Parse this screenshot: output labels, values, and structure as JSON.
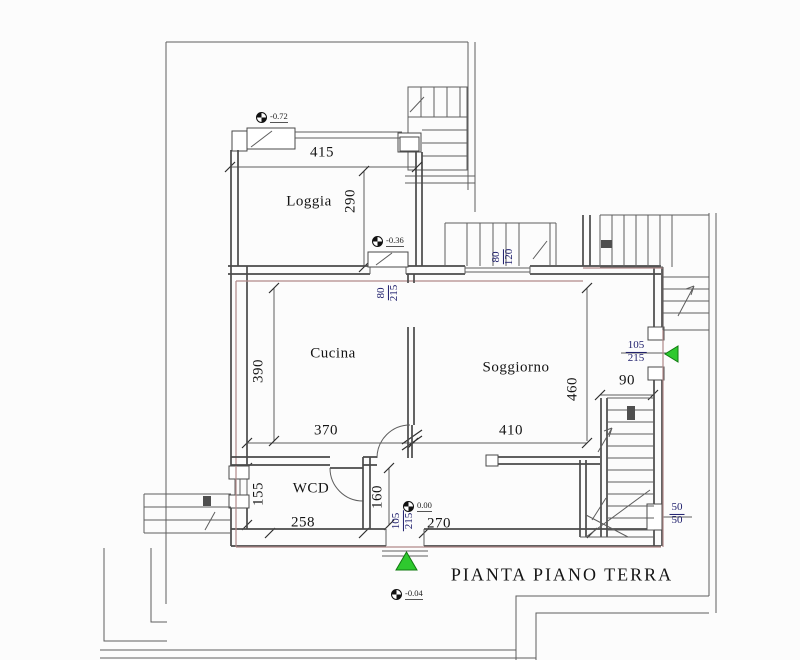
{
  "title": "PIANTA PIANO TERRA",
  "rooms": {
    "loggia": "Loggia",
    "cucina": "Cucina",
    "soggiorno": "Soggiorno",
    "wcd": "WCD"
  },
  "levels": {
    "upper_terrace": "-0.72",
    "loggia": "-0.36",
    "interior": "0.00",
    "exterior": "-0.04"
  },
  "dimensions": {
    "loggia_width": "415",
    "loggia_depth": "290",
    "cucina_width": "370",
    "cucina_depth": "390",
    "soggiorno_width": "410",
    "soggiorno_depth": "460",
    "stair_width": "90",
    "wcd_width": "258",
    "wcd_depth": "155",
    "hall_depth": "160",
    "hall_width": "270"
  },
  "openings": {
    "top_window_w": "80",
    "top_window_h": "120",
    "internal_door_w": "80",
    "internal_door_h": "215",
    "side_door_w": "105",
    "side_door_h": "215",
    "entrance_door_w": "105",
    "entrance_door_h": "215",
    "small_window_w": "50",
    "small_window_h": "50"
  },
  "colors": {
    "wall": "#4a4a4a",
    "thin": "#5e5e5e",
    "red": "#b18989",
    "dim": "#1d1d6b",
    "green": "#2ec92e",
    "green_dark": "#117a11",
    "text": "#141414"
  }
}
